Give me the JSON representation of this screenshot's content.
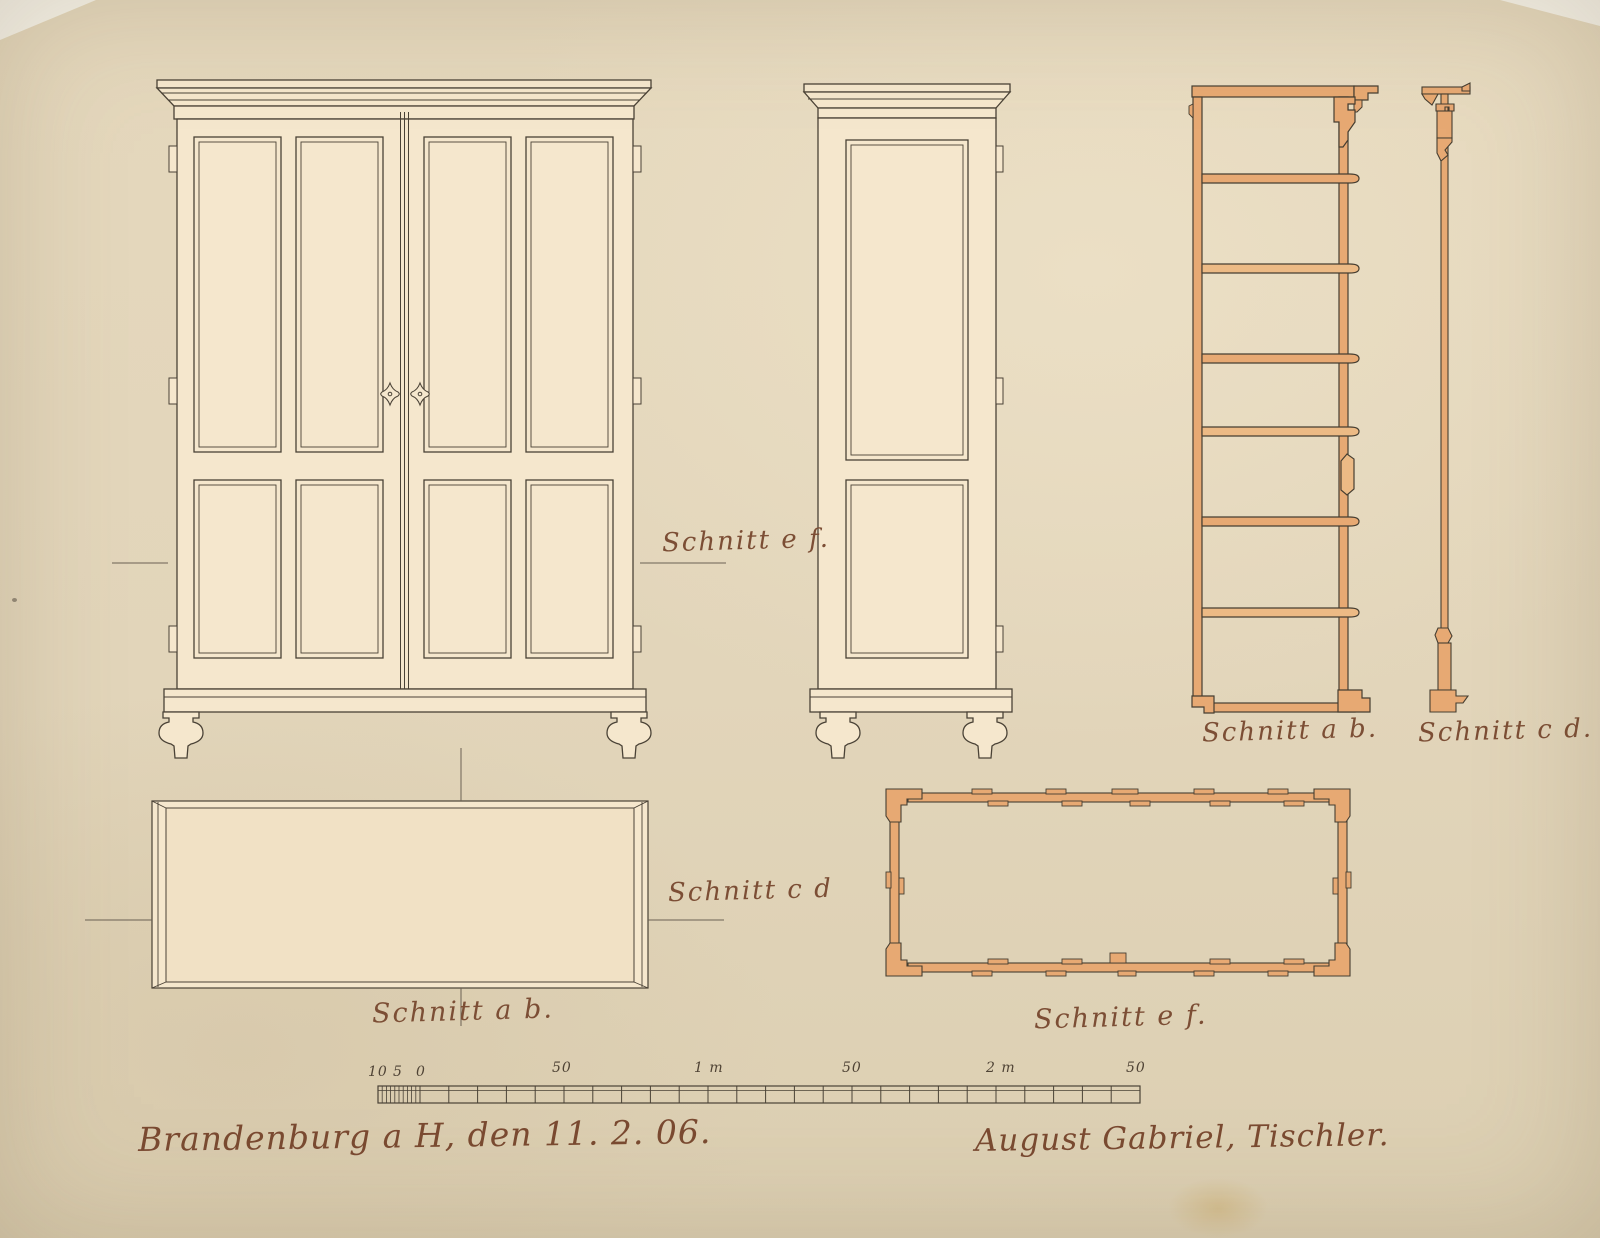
{
  "labels": {
    "schnitt_ef_upper": "Schnitt e f.",
    "schnitt_cd_plan": "Schnitt c d",
    "schnitt_ab_plan": "Schnitt a b.",
    "schnitt_ab_section": "Schnitt a b.",
    "schnitt_cd_section": "Schnitt c d.",
    "schnitt_ef_plan": "Schnitt e f."
  },
  "scale_bar": {
    "labels": [
      "10",
      "5",
      "0",
      "50",
      "1 m",
      "50",
      "2 m",
      "50"
    ]
  },
  "footer": {
    "place_date": "Brandenburg a H, den 11. 2. 06.",
    "signature": "August Gabriel, Tischler."
  },
  "colors": {
    "paper": "#e3d6bb",
    "drawing_fill": "#f5e7cd",
    "section_fill": "#e7a973",
    "ink": "#4a4236",
    "script_ink": "#7c4e35"
  }
}
